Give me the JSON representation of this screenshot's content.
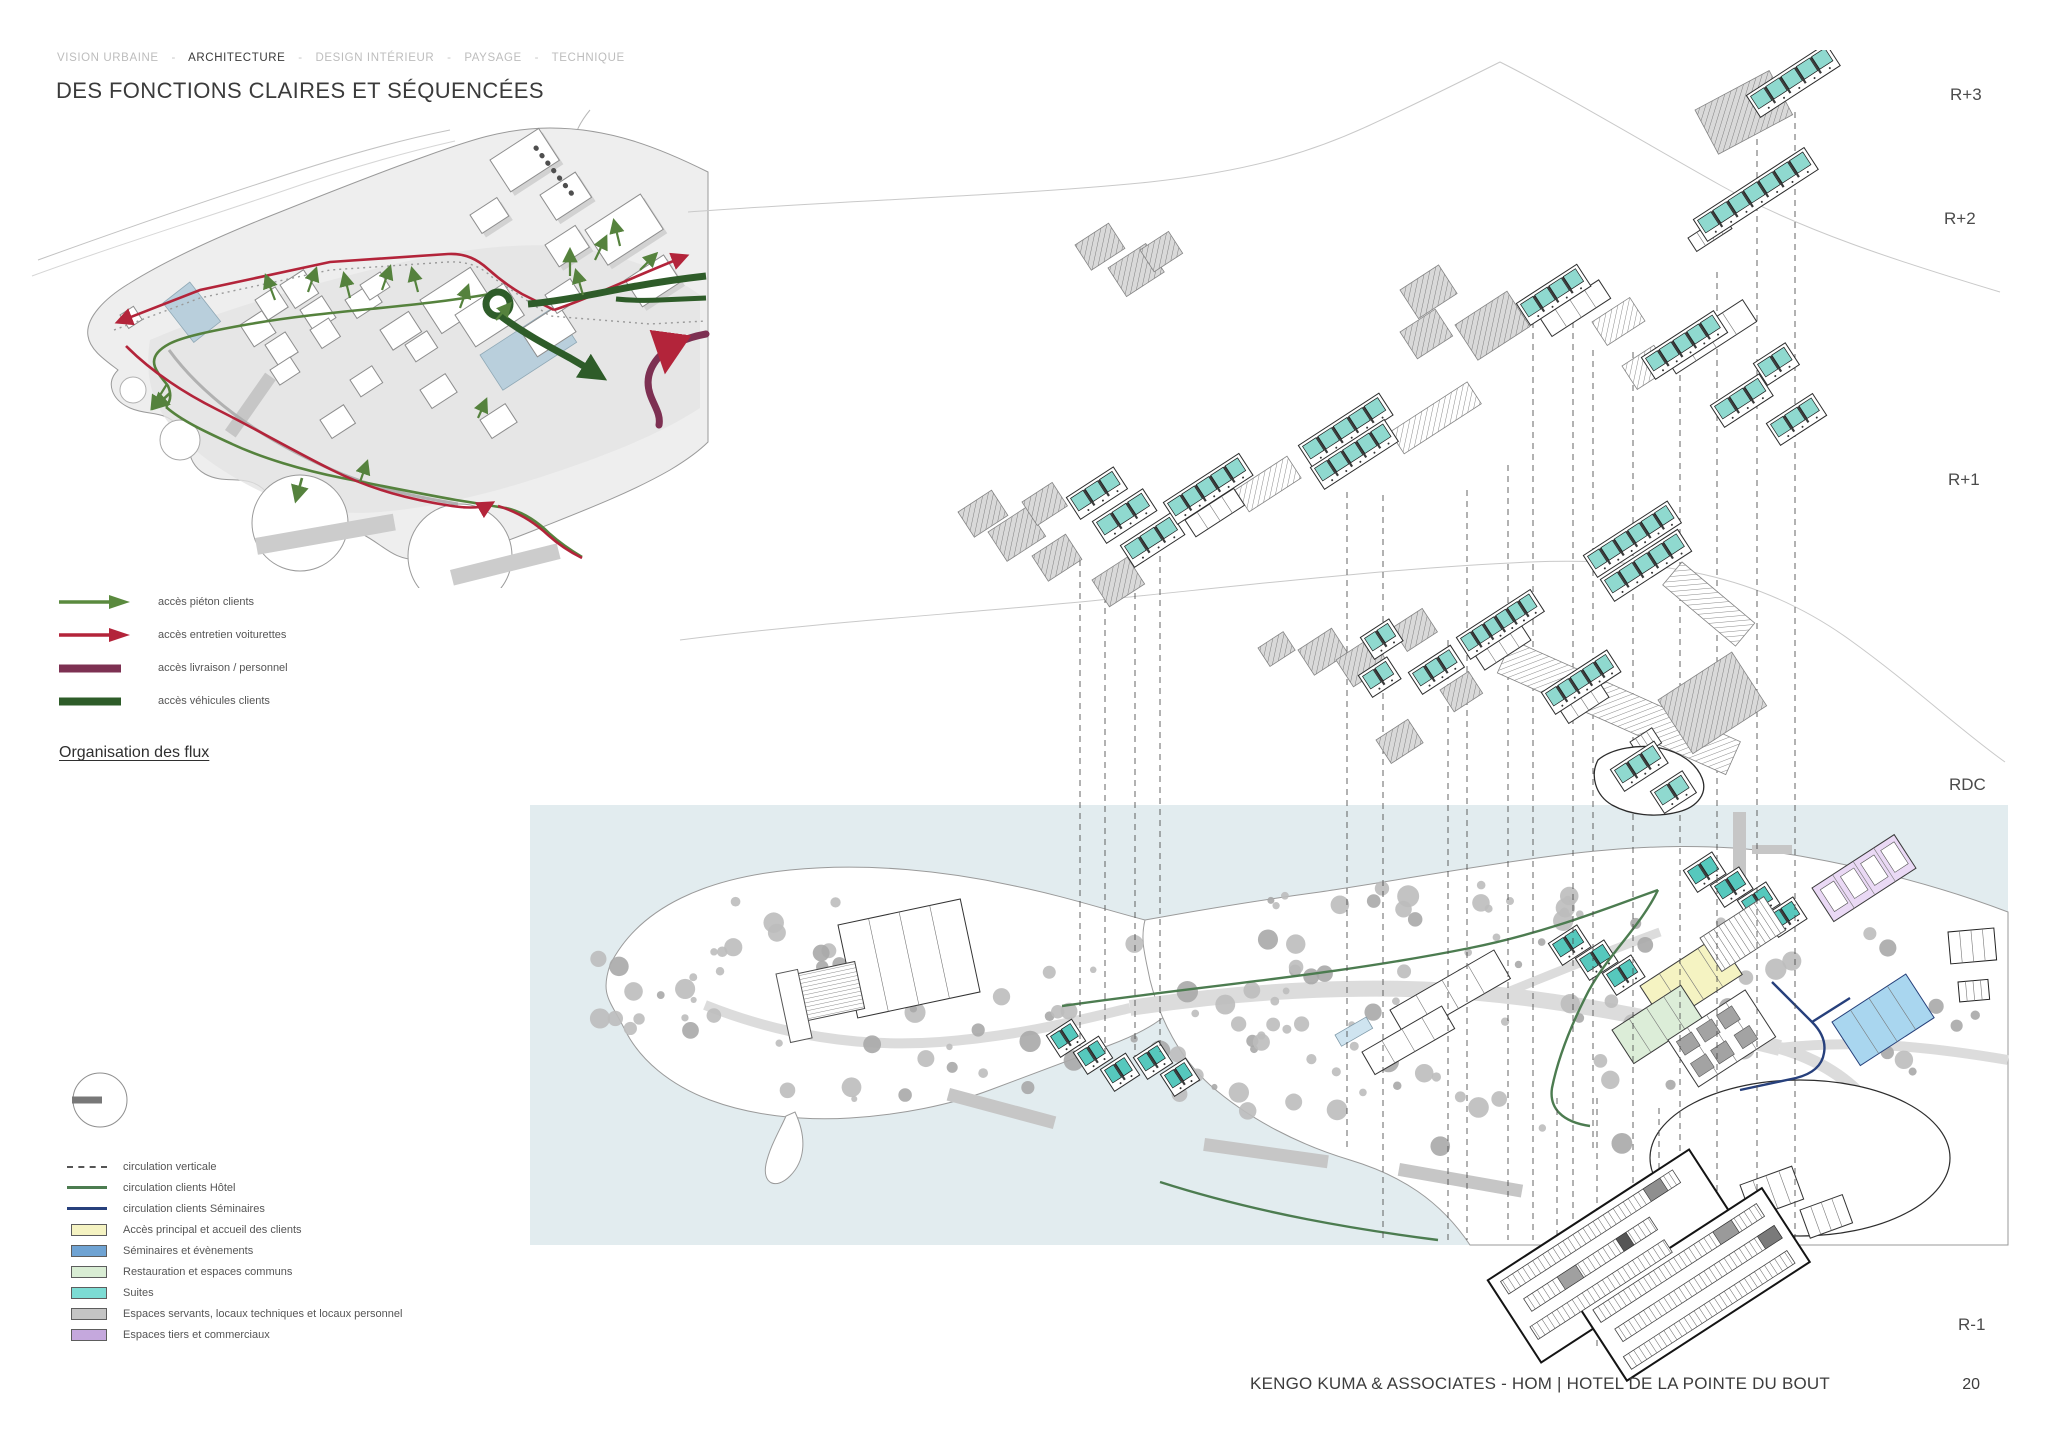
{
  "nav": {
    "separator": "-",
    "items": [
      {
        "label": "VISION URBAINE",
        "active": false
      },
      {
        "label": "ARCHITECTURE",
        "active": true
      },
      {
        "label": "DESIGN INTÉRIEUR",
        "active": false
      },
      {
        "label": "PAYSAGE",
        "active": false
      },
      {
        "label": "TECHNIQUE",
        "active": false
      }
    ]
  },
  "title": "DES FONCTIONS CLAIRES ET SÉQUENCÉES",
  "flow_legend": {
    "items": [
      {
        "label": "accès piéton clients",
        "style": "arrow",
        "color": "#5a8a3e"
      },
      {
        "label": "accès entretien voiturettes",
        "style": "arrow",
        "color": "#b3243a"
      },
      {
        "label": "accès livraison / personnel",
        "style": "bar",
        "color": "#7d3052"
      },
      {
        "label": "accès véhicules clients",
        "style": "bar",
        "color": "#2e5c29"
      }
    ]
  },
  "section_label": "Organisation des flux",
  "levels": {
    "r3": "R+3",
    "r2": "R+2",
    "r1": "R+1",
    "rdc": "RDC",
    "rm1": "R-1"
  },
  "zoning_legend": {
    "items": [
      {
        "label": "circulation verticale",
        "swatch": "dash",
        "color": "#555555"
      },
      {
        "label": "circulation clients Hôtel",
        "swatch": "line",
        "color": "#4c7c50"
      },
      {
        "label": "circulation clients Séminaires",
        "swatch": "line",
        "color": "#27407c"
      },
      {
        "label": "Accès principal et accueil des clients",
        "swatch": "box",
        "color": "#f5f3c2"
      },
      {
        "label": "Séminaires et évènements",
        "swatch": "box",
        "color": "#6fa3d3"
      },
      {
        "label": "Restauration et espaces communs",
        "swatch": "box",
        "color": "#d9edd4"
      },
      {
        "label": "Suites",
        "swatch": "box",
        "color": "#7cdcd4"
      },
      {
        "label": "Espaces servants, locaux techniques et locaux personnel",
        "swatch": "box",
        "color": "#c4c4c4"
      },
      {
        "label": "Espaces tiers et commerciaux",
        "swatch": "box",
        "color": "#c5a8dd"
      }
    ]
  },
  "footer": {
    "credit": "KENGO KUMA & ASSOCIATES  -  HOM | HOTEL DE LA POINTE DU BOUT",
    "page": "20"
  }
}
